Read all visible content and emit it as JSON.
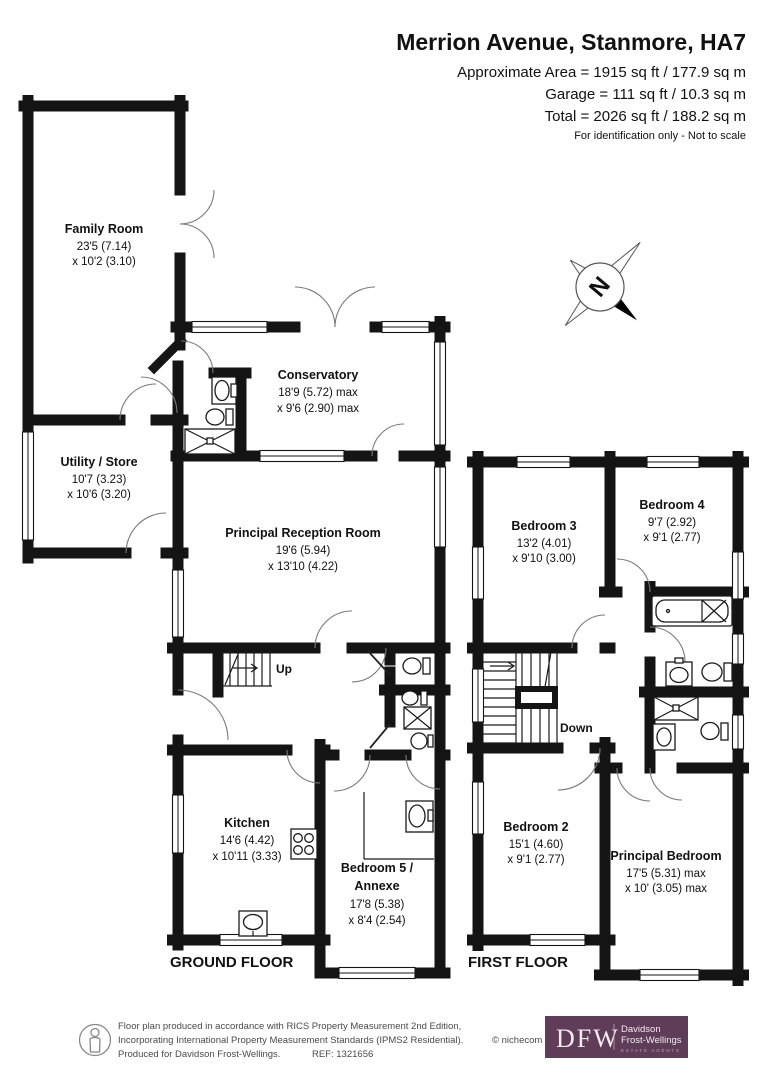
{
  "header": {
    "title": "Merrion Avenue, Stanmore, HA7",
    "area_line1": "Approximate Area = 1915 sq ft / 177.9 sq m",
    "area_line2": "Garage = 111 sq ft / 10.3 sq m",
    "area_line3": "Total = 2026 sq ft / 188.2 sq m",
    "note": "For identification only - Not to scale"
  },
  "compass": {
    "north_label": "N"
  },
  "floor_labels": {
    "ground": "GROUND FLOOR",
    "first": "FIRST FLOOR"
  },
  "stairs": {
    "up": "Up",
    "down": "Down"
  },
  "rooms": {
    "family_room": {
      "name": "Family Room",
      "dim1": "23'5 (7.14)",
      "dim2": "x 10'2 (3.10)"
    },
    "conservatory": {
      "name": "Conservatory",
      "dim1": "18'9 (5.72) max",
      "dim2": "x 9'6 (2.90) max"
    },
    "utility_store": {
      "name": "Utility / Store",
      "dim1": "10'7 (3.23)",
      "dim2": "x 10'6 (3.20)"
    },
    "principal_reception": {
      "name": "Principal Reception Room",
      "dim1": "19'6 (5.94)",
      "dim2": "x 13'10 (4.22)"
    },
    "kitchen": {
      "name": "Kitchen",
      "dim1": "14'6 (4.42)",
      "dim2": "x 10'11 (3.33)"
    },
    "bedroom5": {
      "name_line1": "Bedroom 5 /",
      "name_line2": "Annexe",
      "dim1": "17'8 (5.38)",
      "dim2": "x 8'4 (2.54)"
    },
    "bedroom3": {
      "name": "Bedroom 3",
      "dim1": "13'2 (4.01)",
      "dim2": "x 9'10 (3.00)"
    },
    "bedroom4": {
      "name": "Bedroom 4",
      "dim1": "9'7 (2.92)",
      "dim2": "x 9'1 (2.77)"
    },
    "bedroom2": {
      "name": "Bedroom 2",
      "dim1": "15'1 (4.60)",
      "dim2": "x 9'1 (2.77)"
    },
    "principal_bedroom": {
      "name": "Principal Bedroom",
      "dim1": "17'5 (5.31) max",
      "dim2": "x 10' (3.05) max"
    }
  },
  "footer": {
    "line1": "Floor plan produced in accordance with RICS Property Measurement 2nd Edition,",
    "line2": "Incorporating International Property Measurement Standards (IPMS2 Residential).",
    "copyright": "© nichecom 2025.",
    "line3": "Produced for Davidson Frost-Wellings.",
    "ref": "REF: 1321656",
    "logo": {
      "initials": "DFW",
      "name_line1": "Davidson",
      "name_line2": "Frost-Wellings",
      "tagline": "ESTATE AGENTS",
      "bg_color": "#5f3c57"
    }
  }
}
